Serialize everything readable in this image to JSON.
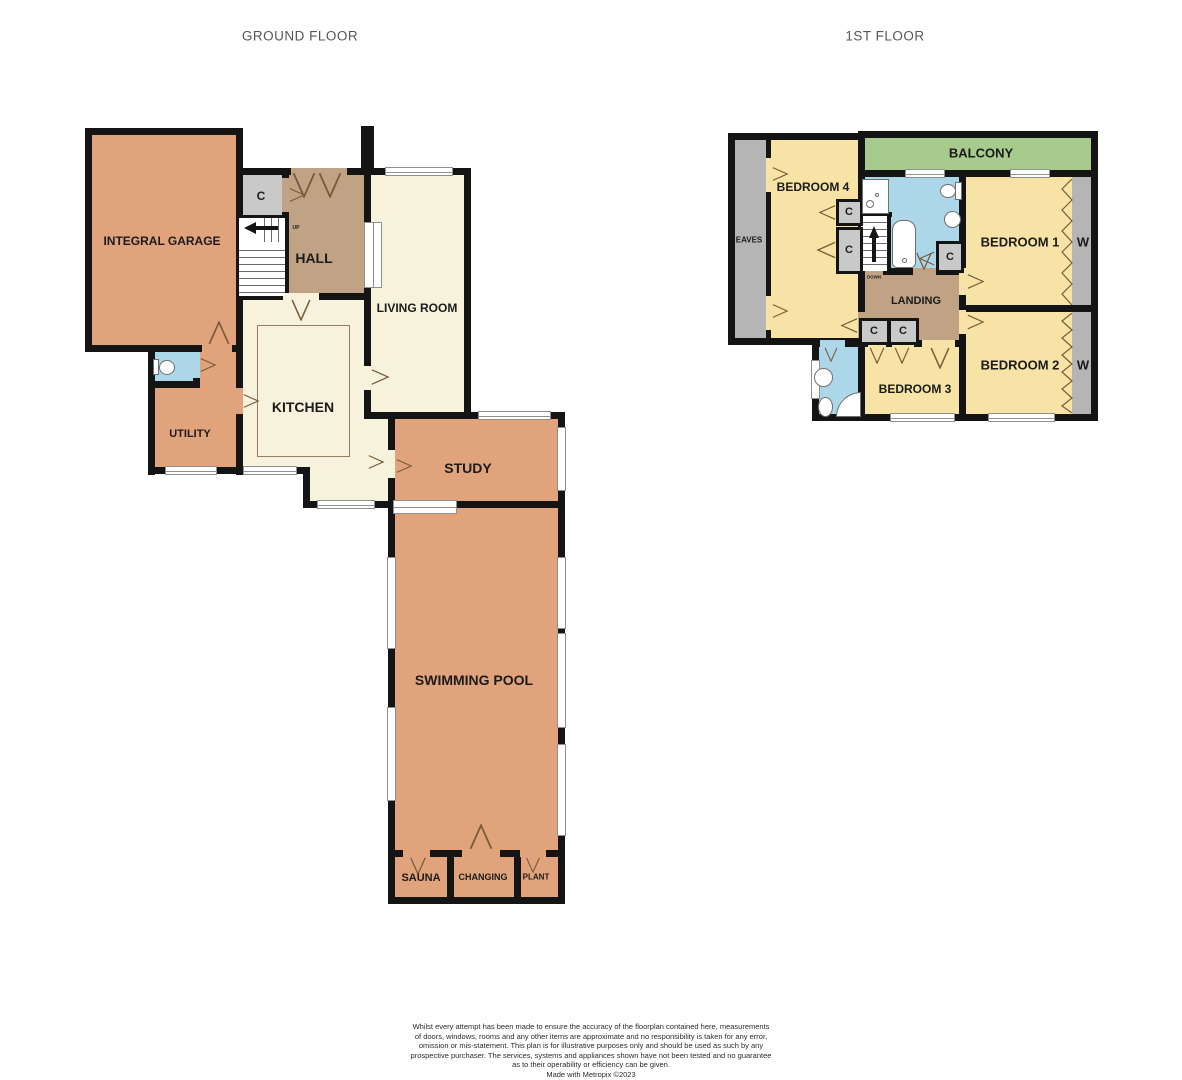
{
  "ground_floor": {
    "title": "GROUND FLOOR",
    "rooms": {
      "garage": "INTEGRAL GARAGE",
      "hall": "HALL",
      "living_room": "LIVING ROOM",
      "kitchen": "KITCHEN",
      "utility": "UTILITY",
      "study": "STUDY",
      "swimming_pool": "SWIMMING POOL",
      "sauna": "SAUNA",
      "changing": "CHANGING",
      "plant": "PLANT"
    },
    "closet_label": "C",
    "stairs_direction": "UP"
  },
  "first_floor": {
    "title": "1ST FLOOR",
    "rooms": {
      "bedroom1": "BEDROOM 1",
      "bedroom2": "BEDROOM 2",
      "bedroom3": "BEDROOM 3",
      "bedroom4": "BEDROOM 4",
      "landing": "LANDING",
      "balcony": "BALCONY",
      "eaves": "EAVES"
    },
    "closet_label": "C",
    "wardrobe_label": "W",
    "stairs_direction": "DOWN"
  },
  "colors": {
    "room_salmon": "#E1A37B",
    "room_cream": "#F7F2DC",
    "room_tan": "#C0A384",
    "room_yellow": "#F6E3A5",
    "room_green": "#A7CB8D",
    "room_blue": "#ABD7E8",
    "room_gray": "#C9C9C9",
    "eaves_gray": "#B5B5B5",
    "wall": "#141414",
    "title_text": "#56575B"
  },
  "footer": {
    "lines": [
      "Whilst every attempt has been made to ensure the accuracy of the floorplan contained here, measurements",
      "of doors, windows, rooms and any other items are approximate and no responsibility is taken for any error,",
      "omission or mis-statement. This plan is for illustrative purposes only and should be used as such by any",
      "prospective purchaser. The services, systems and appliances shown have not been tested and no guarantee",
      "as to their operability or efficiency can be given.",
      "Made with Metropix ©2023"
    ]
  }
}
